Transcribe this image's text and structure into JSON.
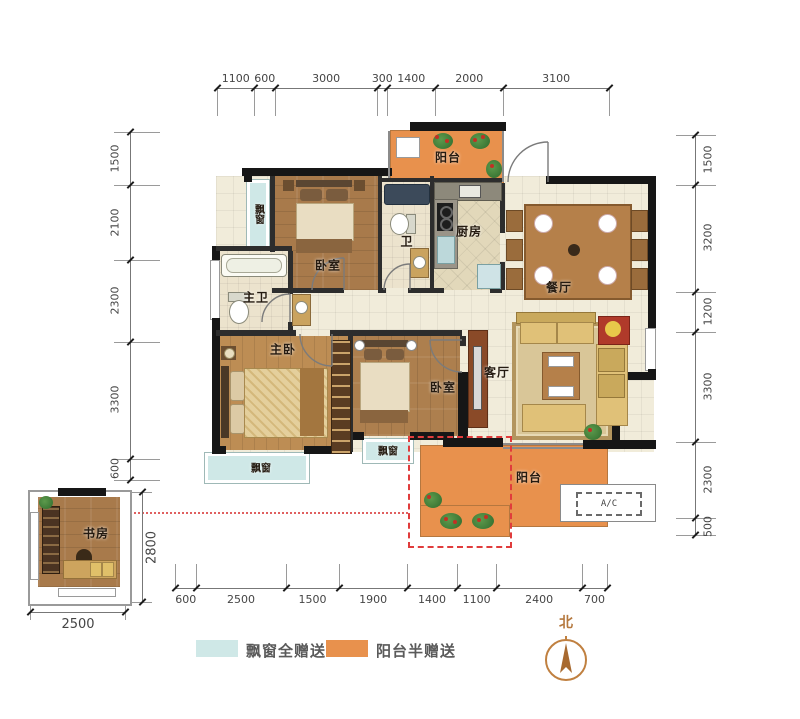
{
  "rooms": {
    "bedroom_top": "卧室",
    "bedroom_second": "卧室",
    "master_bedroom": "主卧",
    "master_bath": "主卫",
    "bath": "卫",
    "kitchen": "厨房",
    "dining": "餐厅",
    "living": "客厅",
    "balcony_top": "阳台",
    "balcony_bottom": "阳台",
    "bay_window_top": "飘窗",
    "bay_window_master": "飘窗",
    "bay_window_second": "飘窗",
    "study": "书房"
  },
  "ac": {
    "label": "A/C"
  },
  "compass": {
    "label": "北"
  },
  "dimensions": {
    "top": [
      "1100",
      "600",
      "3000",
      "300",
      "1400",
      "2000",
      "3100"
    ],
    "left": [
      "1500",
      "2100",
      "2300",
      "3300",
      "600"
    ],
    "right": [
      "1500",
      "3200",
      "1200",
      "3300",
      "2300",
      "500"
    ],
    "bottom": [
      "600",
      "2500",
      "1500",
      "1900",
      "1400",
      "1100",
      "2400",
      "700"
    ],
    "study_width": "2500",
    "study_height": "2800"
  },
  "legend": {
    "items": [
      {
        "label": "飘窗全赠送",
        "color": "#cfe8e7"
      },
      {
        "label": "阳台半赠送",
        "color": "#e8914d"
      }
    ]
  },
  "colors": {
    "bay": "#cfe8e7",
    "balcony": "#e8914d",
    "gift_dash": "#e03c3c"
  }
}
